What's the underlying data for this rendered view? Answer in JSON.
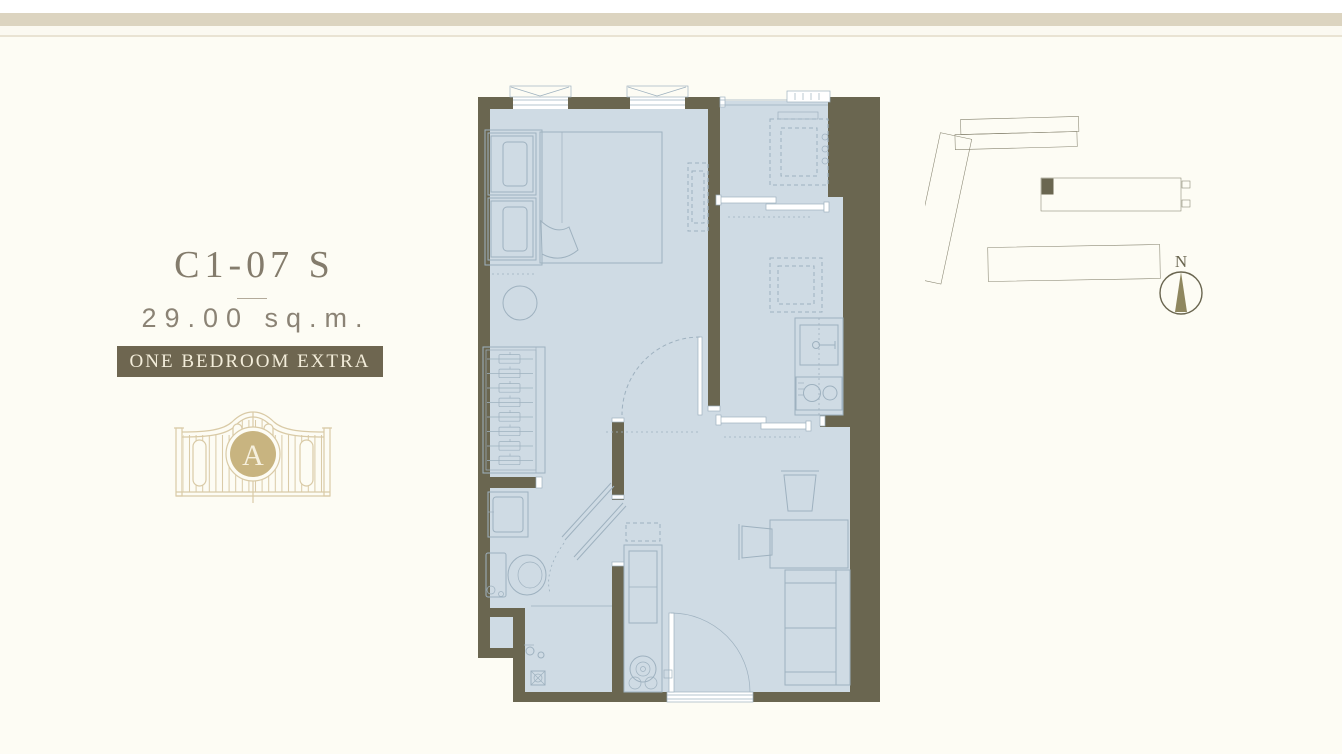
{
  "unit": {
    "code": "C1-07 S",
    "area": "29.00 sq.m.",
    "type_label": "ONE BEDROOM EXTRA"
  },
  "logo": {
    "monogram": "A"
  },
  "site_plan": {
    "compass_label": "N"
  },
  "colors": {
    "wall": "#6a6650",
    "floor": "#cfdbe4",
    "line": "#9eb1bf",
    "badge_bg": "#6e6650",
    "badge_text": "#f3edda",
    "title_text": "#847c6c",
    "muted_text": "#8b8375",
    "gold": "#d9caa6",
    "gold_fill": "#c8b480",
    "site_line": "#86836f",
    "band": "#dcd4c0",
    "bg": "#fdfcf4"
  }
}
